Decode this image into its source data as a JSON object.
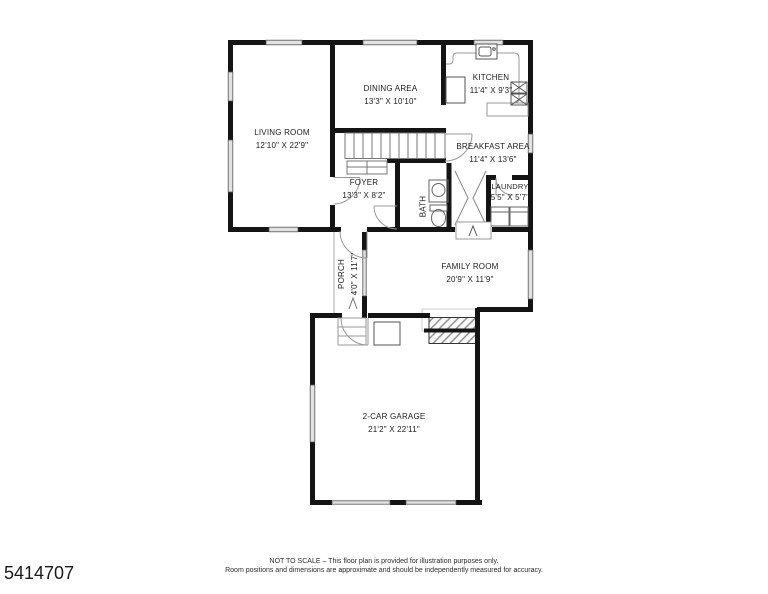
{
  "listing_id": "5414707",
  "footer": {
    "line1": "NOT TO SCALE – This floor plan is provided for illustration purposes only.",
    "line2": "Room positions and dimensions are approximate and should be independently measured for accuracy."
  },
  "rooms": {
    "living_room": {
      "name": "LIVING ROOM",
      "dims": "12'10\" X 22'9\""
    },
    "dining_area": {
      "name": "DINING AREA",
      "dims": "13'3\" X 10'10\""
    },
    "kitchen": {
      "name": "KITCHEN",
      "dims": "11'4\" X 9'3\""
    },
    "breakfast_area": {
      "name": "BREAKFAST AREA",
      "dims": "11'4\" X 13'6\""
    },
    "foyer": {
      "name": "FOYER",
      "dims": "13'3\" X 8'2\""
    },
    "bath": {
      "name": "BATH",
      "dims": ""
    },
    "laundry": {
      "name": "LAUNDRY",
      "dims": "5'5\" X 5'7\""
    },
    "porch": {
      "name": "PORCH",
      "dims": "4'0\" X 11'7\""
    },
    "family_room": {
      "name": "FAMILY ROOM",
      "dims": "20'9\" X 11'9\""
    },
    "garage": {
      "name": "2-CAR GARAGE",
      "dims": "21'2\" X 22'11\""
    }
  },
  "colors": {
    "wall": "#141414",
    "window_fill": "#e2e2e2",
    "thin_line": "#999999",
    "background": "#ffffff"
  }
}
